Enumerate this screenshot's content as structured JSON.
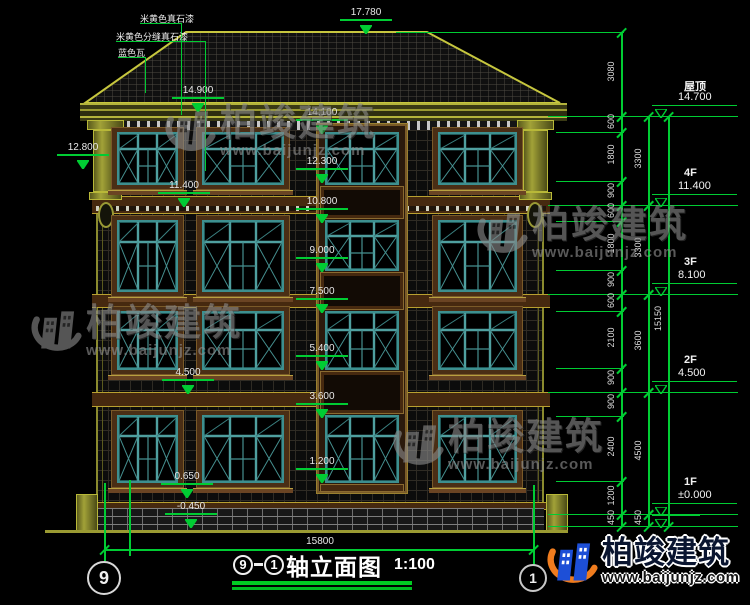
{
  "colors": {
    "dim_green": "#00cc33",
    "outline_olive": "#c6c63e",
    "window_teal": "#3d8f8f",
    "surround_brown": "#4a2e15",
    "watermark_gray": "#8a8a8a",
    "logo_blue": "#1d4fd7",
    "logo_orange": "#f07c1e",
    "title_underline": "#00cc22"
  },
  "material_labels": [
    "米黄色真石漆",
    "米黄色分缝真石漆",
    "蓝色瓦"
  ],
  "level_markers": [
    {
      "label": "17.780",
      "elev": 17.78,
      "x": 366
    },
    {
      "label": "14.900",
      "elev": 14.9,
      "x": 198
    },
    {
      "label": "14.100",
      "elev": 14.1,
      "x": 322
    },
    {
      "label": "12.800",
      "elev": 12.8,
      "x": 83
    },
    {
      "label": "12.300",
      "elev": 12.3,
      "x": 322
    },
    {
      "label": "11.400",
      "elev": 11.4,
      "x": 184
    },
    {
      "label": "10.800",
      "elev": 10.8,
      "x": 322
    },
    {
      "label": "9.000",
      "elev": 9.0,
      "x": 322
    },
    {
      "label": "7.500",
      "elev": 7.5,
      "x": 322
    },
    {
      "label": "5.400",
      "elev": 5.4,
      "x": 322
    },
    {
      "label": "4.500",
      "elev": 4.5,
      "x": 188
    },
    {
      "label": "3.600",
      "elev": 3.6,
      "x": 322
    },
    {
      "label": "1.200",
      "elev": 1.2,
      "x": 322
    },
    {
      "label": "0.650",
      "elev": 0.65,
      "x": 187
    },
    {
      "label": "-0.450",
      "elev": -0.45,
      "x": 191
    }
  ],
  "right_dimensions": {
    "chains": [
      {
        "segments": [
          {
            "label": "3080",
            "from": 17.78,
            "to": 14.7
          },
          {
            "label": "600",
            "from": 14.7,
            "to": 14.1
          },
          {
            "label": "1800",
            "from": 14.1,
            "to": 12.3
          },
          {
            "label": "900",
            "from": 12.3,
            "to": 11.4
          },
          {
            "label": "600",
            "from": 11.4,
            "to": 10.8
          },
          {
            "label": "1800",
            "from": 10.8,
            "to": 9.0
          },
          {
            "label": "900",
            "from": 9.0,
            "to": 8.1
          },
          {
            "label": "600",
            "from": 8.1,
            "to": 7.5
          },
          {
            "label": "2100",
            "from": 7.5,
            "to": 5.4
          },
          {
            "label": "900",
            "from": 5.4,
            "to": 4.5
          },
          {
            "label": "900",
            "from": 4.5,
            "to": 3.6
          },
          {
            "label": "2400",
            "from": 3.6,
            "to": 1.2
          },
          {
            "label": "1200",
            "from": 1.2,
            "to": 0
          },
          {
            "label": "450",
            "from": 0,
            "to": -0.45
          }
        ]
      },
      {
        "segments": [
          {
            "label": "3300",
            "from": 14.7,
            "to": 11.4
          },
          {
            "label": "3300",
            "from": 11.4,
            "to": 8.1
          },
          {
            "label": "3600",
            "from": 8.1,
            "to": 4.5
          },
          {
            "label": "4500",
            "from": 4.5,
            "to": 0
          },
          {
            "label": "450",
            "from": 0,
            "to": -0.45
          }
        ]
      },
      {
        "segments": [
          {
            "label": "15150",
            "from": 14.7,
            "to": -0.45
          }
        ]
      }
    ],
    "floor_levels": [
      {
        "name": "屋顶",
        "value": "14.700",
        "elev": 14.7
      },
      {
        "name": "4F",
        "value": "11.400",
        "elev": 11.4
      },
      {
        "name": "3F",
        "value": "8.100",
        "elev": 8.1
      },
      {
        "name": "2F",
        "value": "4.500",
        "elev": 4.5
      },
      {
        "name": "1F",
        "value": "±0.000",
        "elev": 0
      }
    ]
  },
  "bottom_dimension": {
    "label": "15800"
  },
  "axis_bubbles": {
    "left": "9",
    "right": "1"
  },
  "title": {
    "bubble_left": "9",
    "bubble_right": "1",
    "text": "轴立面图",
    "scale": "1:100"
  },
  "watermark": {
    "brand": "柏竣建筑",
    "url": "www.baijunjz.com"
  }
}
